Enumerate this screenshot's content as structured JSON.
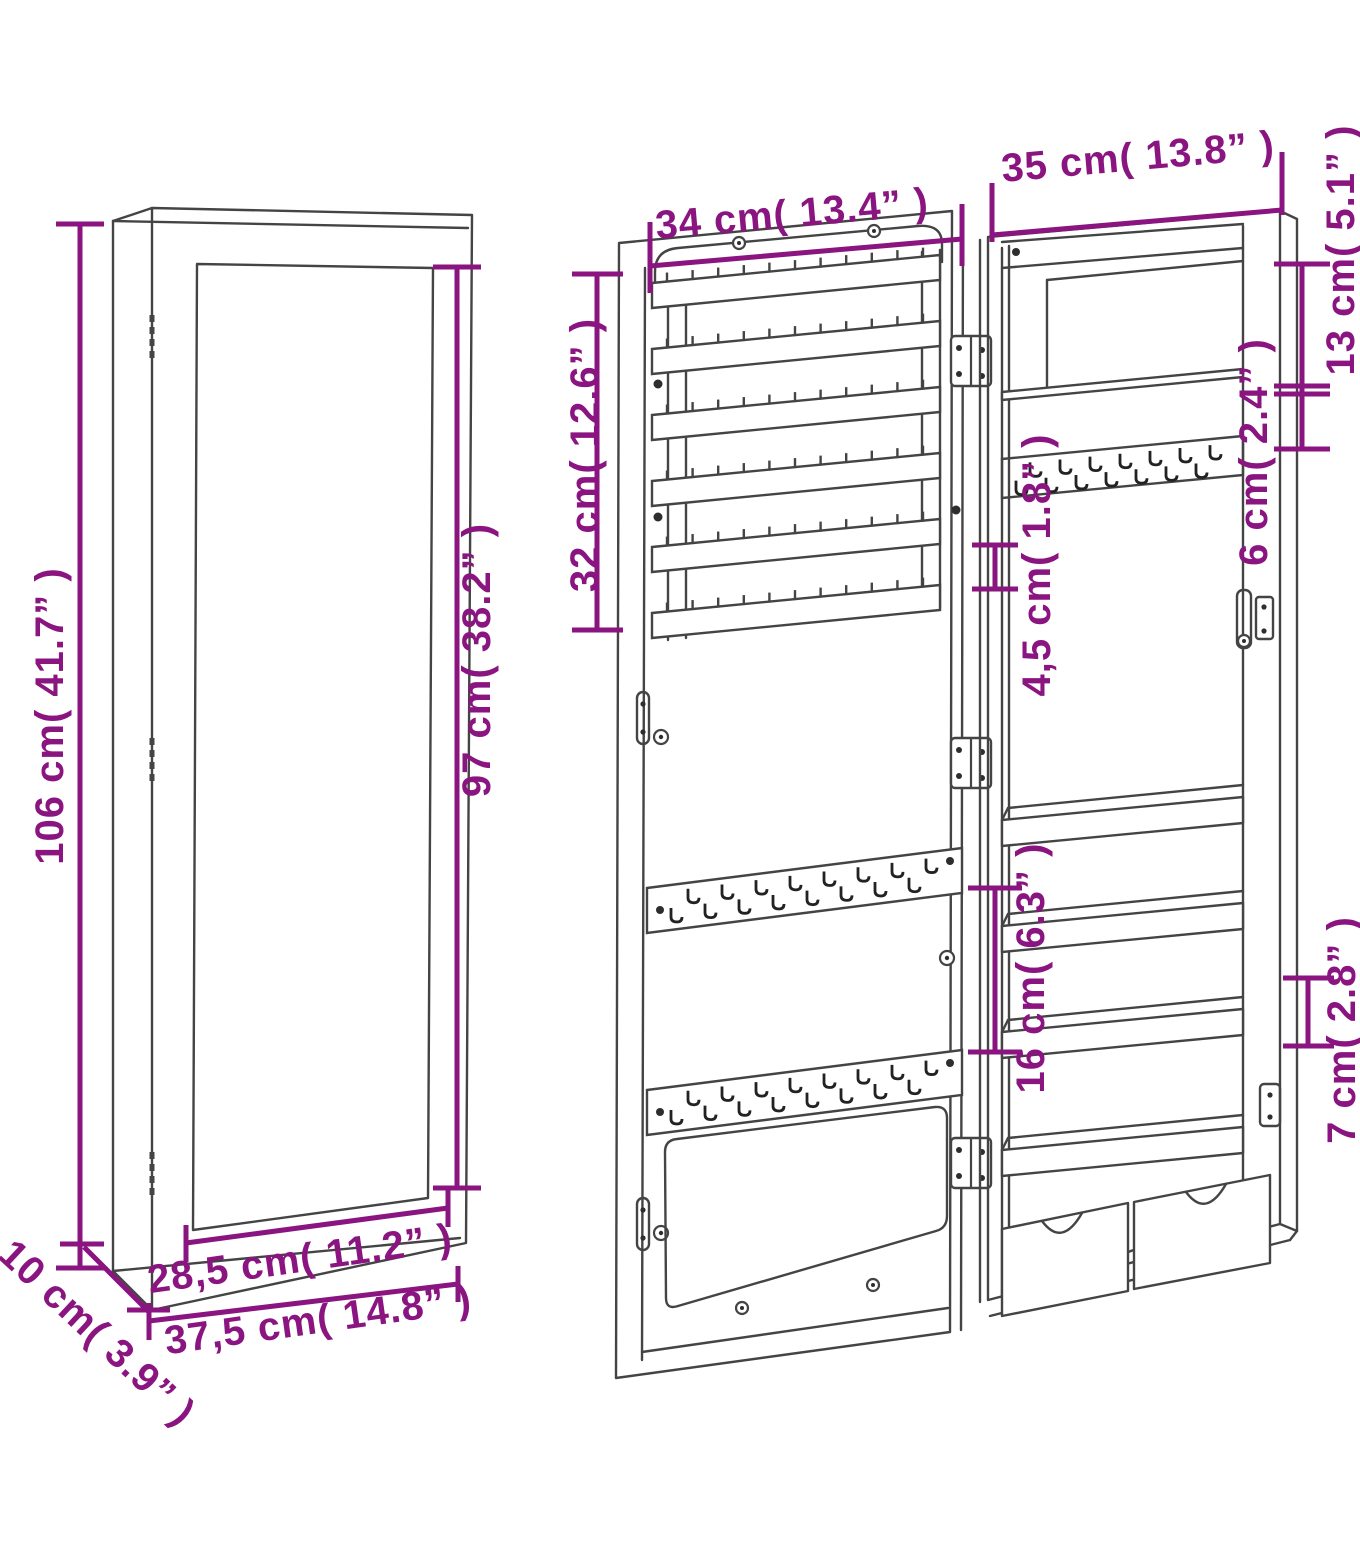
{
  "diagram": {
    "type": "furniture-dimension-diagram",
    "product": "wall-mounted mirror jewelry cabinet",
    "colors": {
      "dimension_accent": "#8a1480",
      "line": "#444444",
      "background": "#ffffff"
    },
    "views": {
      "closed": "closed cabinet with mirror (front-left view)",
      "door": "open door interior with earring racks and hook strips",
      "cabinet": "cabinet interior with shelves and drawers"
    },
    "dimensions": {
      "overall_height": "106 cm( 41.7” )",
      "mirror_height": "97 cm( 38.2” )",
      "mirror_width": "28,5 cm( 11.2” )",
      "overall_width": "37,5 cm( 14.8” )",
      "depth": "10 cm( 3.9” )",
      "door_rack_width": "34 cm( 13.4” )",
      "door_rack_height": "32 cm( 12.6” )",
      "cabinet_width": "35 cm( 13.8” )",
      "top_compartment_height": "13 cm( 5.1” )",
      "shelf_to_hooks_gap": "6 cm( 2.4” )",
      "hook_clearance": "4,5 cm( 1.8” )",
      "shelf_spacing": "16 cm( 6.3” )",
      "bottom_shelf_height": "7 cm( 2.8” )"
    }
  }
}
